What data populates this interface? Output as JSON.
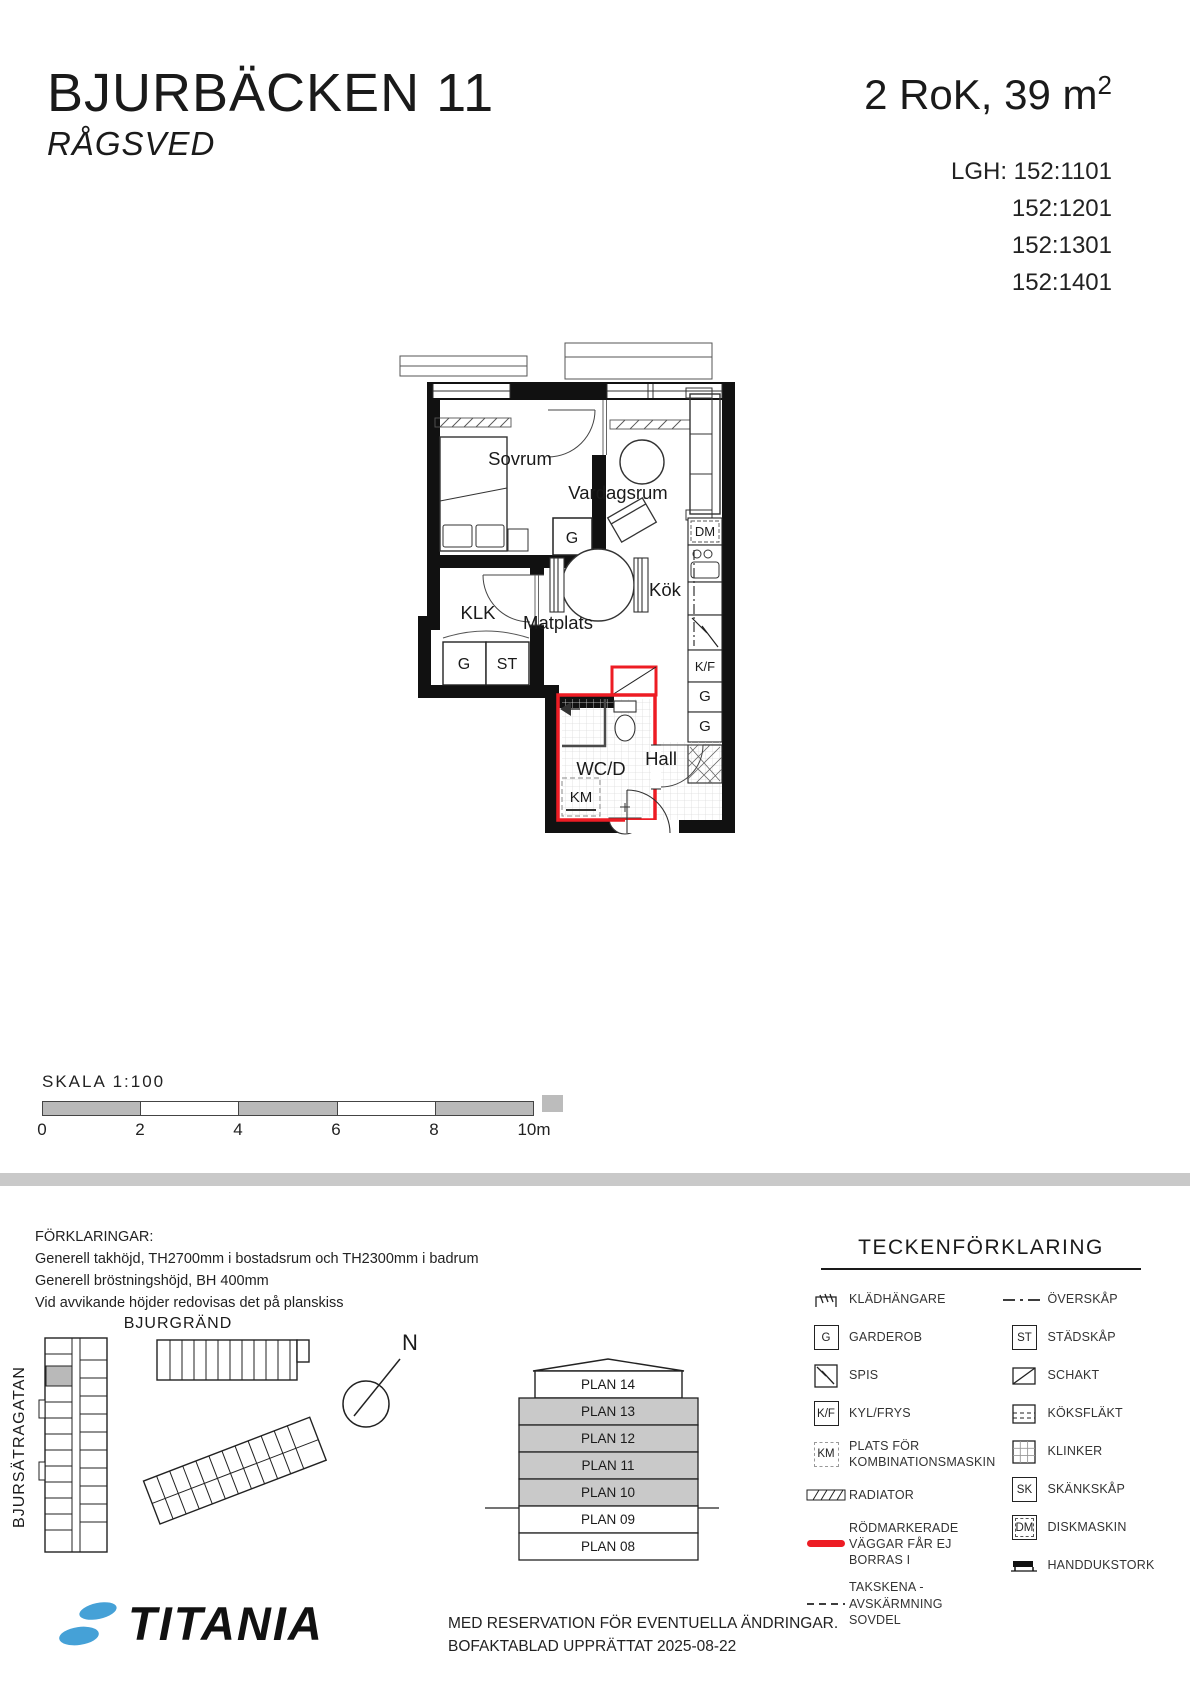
{
  "header": {
    "title": "BJURBÄCKEN 11",
    "subtitle": "RÅGSVED",
    "size_label": "2 RoK, 39 m",
    "size_sup": "2",
    "lgh_prefix": "LGH:",
    "lgh_numbers": [
      "152:1101",
      "152:1201",
      "152:1301",
      "152:1401"
    ]
  },
  "glyphs": {
    "g": "G",
    "st": "ST",
    "kf": "K/F",
    "km": "KM",
    "sk": "SK",
    "dm": "DM"
  },
  "plan": {
    "rooms": {
      "sovrum": "Sovrum",
      "vardagsrum": "Vardagsrum",
      "klk": "KLK",
      "kok": "Kök",
      "matplats": "Matplats",
      "wcd": "WC/D",
      "hall": "Hall"
    }
  },
  "scale": {
    "label": "SKALA  1:100",
    "ticks": [
      "0",
      "2",
      "4",
      "6",
      "8",
      "10m"
    ]
  },
  "notes": {
    "title": "FÖRKLARINGAR:",
    "lines": [
      "Generell takhöjd, TH2700mm i bostadsrum och TH2300mm i badrum",
      "Generell bröstningshöjd, BH 400mm",
      "Vid avvikande höjder redovisas det på planskiss"
    ]
  },
  "siteplan": {
    "street_top": "BJURGRÄND",
    "street_left": "BJURSÄTRAGATAN",
    "north": "N"
  },
  "section": {
    "floors": [
      {
        "label": "PLAN 14",
        "shaded": false
      },
      {
        "label": "PLAN 13",
        "shaded": true
      },
      {
        "label": "PLAN 12",
        "shaded": true
      },
      {
        "label": "PLAN 11",
        "shaded": true
      },
      {
        "label": "PLAN 10",
        "shaded": true
      },
      {
        "label": "PLAN 09",
        "shaded": false
      },
      {
        "label": "PLAN 08",
        "shaded": false
      }
    ]
  },
  "legend": {
    "title": "TECKENFÖRKLARING",
    "left": [
      {
        "label": "KLÄDHÄNGARE"
      },
      {
        "label": "GARDEROB"
      },
      {
        "label": "SPIS"
      },
      {
        "label": "KYL/FRYS"
      },
      {
        "label": "PLATS FÖR",
        "label2": "KOMBINATIONSMASKIN"
      },
      {
        "label": "RADIATOR"
      },
      {
        "label": "RÖDMARKERADE",
        "label2": "VÄGGAR FÅR EJ BORRAS I"
      },
      {
        "label": "TAKSKENA -",
        "label2": "AVSKÄRMNING SOVDEL"
      }
    ],
    "right": [
      {
        "label": "ÖVERSKÅP"
      },
      {
        "label": "STÄDSKÅP"
      },
      {
        "label": "SCHAKT"
      },
      {
        "label": "KÖKSFLÄKT"
      },
      {
        "label": "KLINKER"
      },
      {
        "label": "SKÄNKSKÅP"
      },
      {
        "label": "DISKMASKIN"
      },
      {
        "label": "HANDDUKSTORK"
      }
    ]
  },
  "footer": {
    "brand": "TITANIA",
    "line1": "MED RESERVATION FÖR EVENTUELLA ÄNDRINGAR.",
    "line2": "BOFAKTABLAD UPPRÄTTAT 2025-08-22"
  },
  "colors": {
    "red": "#ed1c24",
    "blue": "#45a1d7",
    "gray": "#c9c9c9"
  }
}
